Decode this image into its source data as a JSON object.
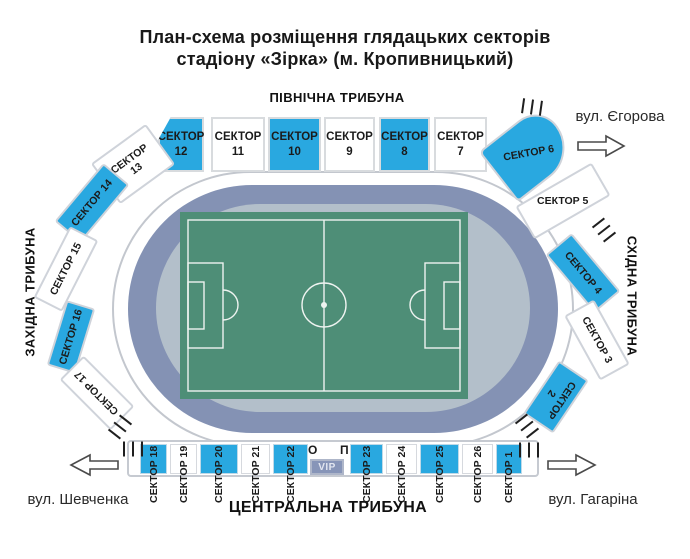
{
  "title": {
    "line1": "План-схема розміщення глядацьких секторів",
    "line2": "стадіону «Зірка» (м. Кропивницький)"
  },
  "stands": {
    "north": "ПІВНІЧНА ТРИБУНА",
    "south": "ЦЕНТРАЛЬНА ТРИБУНА",
    "west": "ЗАХІДНА ТРИБУНА",
    "east": "СХІДНА ТРИБУНА"
  },
  "streets": {
    "top_right": "вул. Єгорова",
    "bottom_left": "вул. Шевченка",
    "bottom_right": "вул. Гагаріна"
  },
  "vip_area": {
    "vip_label": "VIP",
    "o_mark": "О",
    "p_mark": "П"
  },
  "colors": {
    "sector_highlight": "#29a8e0",
    "sector_plain": "#ffffff",
    "track": "#8492b4",
    "infield": "#b3bfca",
    "pitch": "#4e8e77",
    "vip_bg": "#8795b8"
  },
  "sectors": [
    {
      "num": "1",
      "word": "СЕКТОР",
      "label": "СЕКТОР 1",
      "fill": "blue"
    },
    {
      "num": "2",
      "word": "СЕКТОР",
      "label": "СЕКТОР 2",
      "fill": "blue"
    },
    {
      "num": "3",
      "word": "СЕКТОР",
      "label": "СЕКТОР 3",
      "fill": "white"
    },
    {
      "num": "4",
      "word": "СЕКТОР",
      "label": "СЕКТОР 4",
      "fill": "blue"
    },
    {
      "num": "5",
      "word": "СЕКТОР",
      "label": "СЕКТОР 5",
      "fill": "white"
    },
    {
      "num": "6",
      "word": "СЕКТОР",
      "label": "СЕКТОР 6",
      "fill": "blue"
    },
    {
      "num": "7",
      "word": "СЕКТОР",
      "label": "СЕКТОР 7",
      "fill": "white"
    },
    {
      "num": "8",
      "word": "СЕКТОР",
      "label": "СЕКТОР 8",
      "fill": "blue"
    },
    {
      "num": "9",
      "word": "СЕКТОР",
      "label": "СЕКТОР 9",
      "fill": "white"
    },
    {
      "num": "10",
      "word": "СЕКТОР",
      "label": "СЕКТОР 10",
      "fill": "blue"
    },
    {
      "num": "11",
      "word": "СЕКТОР",
      "label": "СЕКТОР 11",
      "fill": "white"
    },
    {
      "num": "12",
      "word": "СЕКТОР",
      "label": "СЕКТОР 12",
      "fill": "blue"
    },
    {
      "num": "13",
      "word": "СЕКТОР",
      "label": "СЕКТОР 13",
      "fill": "white"
    },
    {
      "num": "14",
      "word": "СЕКТОР",
      "label": "СЕКТОР 14",
      "fill": "blue"
    },
    {
      "num": "15",
      "word": "СЕКТОР",
      "label": "СЕКТОР 15",
      "fill": "white"
    },
    {
      "num": "16",
      "word": "СЕКТОР",
      "label": "СЕКТОР 16",
      "fill": "blue"
    },
    {
      "num": "17",
      "word": "СЕКТОР",
      "label": "СЕКТОР 17",
      "fill": "white"
    },
    {
      "num": "18",
      "word": "СЕКТОР",
      "label": "СЕКТОР 18",
      "fill": "blue"
    },
    {
      "num": "19",
      "word": "СЕКТОР",
      "label": "СЕКТОР 19",
      "fill": "white"
    },
    {
      "num": "20",
      "word": "СЕКТОР",
      "label": "СЕКТОР 20",
      "fill": "blue"
    },
    {
      "num": "21",
      "word": "СЕКТОР",
      "label": "СЕКТОР 21",
      "fill": "white"
    },
    {
      "num": "22",
      "word": "СЕКТОР",
      "label": "СЕКТОР 22",
      "fill": "blue"
    },
    {
      "num": "23",
      "word": "СЕКТОР",
      "label": "СЕКТОР 23",
      "fill": "blue"
    },
    {
      "num": "24",
      "word": "СЕКТОР",
      "label": "СЕКТОР 24",
      "fill": "white"
    },
    {
      "num": "25",
      "word": "СЕКТОР",
      "label": "СЕКТОР 25",
      "fill": "blue"
    },
    {
      "num": "26",
      "word": "СЕКТОР",
      "label": "СЕКТОР 26",
      "fill": "white"
    }
  ]
}
